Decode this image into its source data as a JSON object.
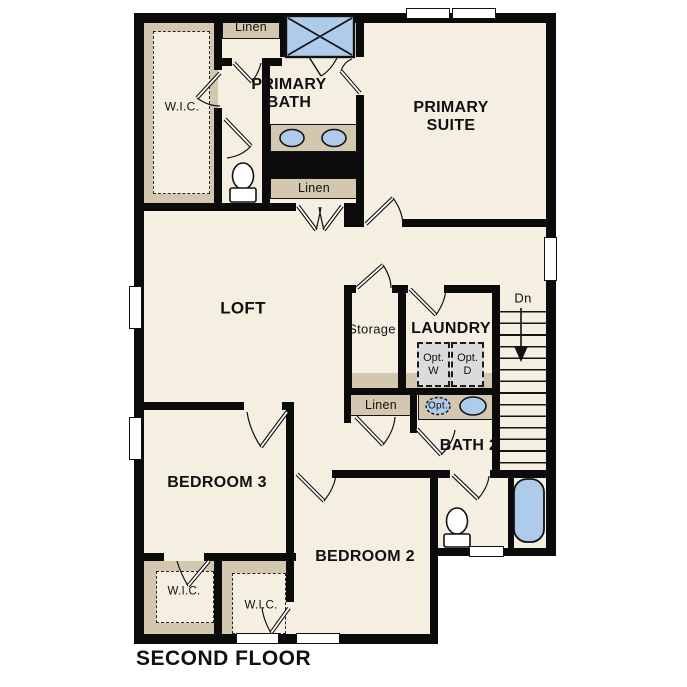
{
  "title": "SECOND FLOOR",
  "colors": {
    "wall": "#0B0B0B",
    "floor": "#F5EFE2",
    "closet_tan": "#D3C7B0",
    "fixture_blue": "#AECBEA",
    "appliance_gray": "#DBDBDB",
    "text": "#111111"
  },
  "labels": {
    "wic_primary": "W.I.C.",
    "linen_top": "Linen",
    "primary_bath": "PRIMARY\nBATH",
    "primary_suite": "PRIMARY\nSUITE",
    "linen_mid": "Linen",
    "loft": "LOFT",
    "storage": "Storage",
    "laundry": "LAUNDRY",
    "opt_washer": "Opt.\nW",
    "opt_dryer": "Opt.\nD",
    "stairs_dn": "Dn",
    "linen_hall": "Linen",
    "bath2": "BATH 2",
    "opt_sink": "Opt.",
    "bedroom3": "BEDROOM 3",
    "bedroom2": "BEDROOM 2",
    "wic_bedroom3": "W.I.C.",
    "wic_bedroom2": "W.I.C."
  }
}
